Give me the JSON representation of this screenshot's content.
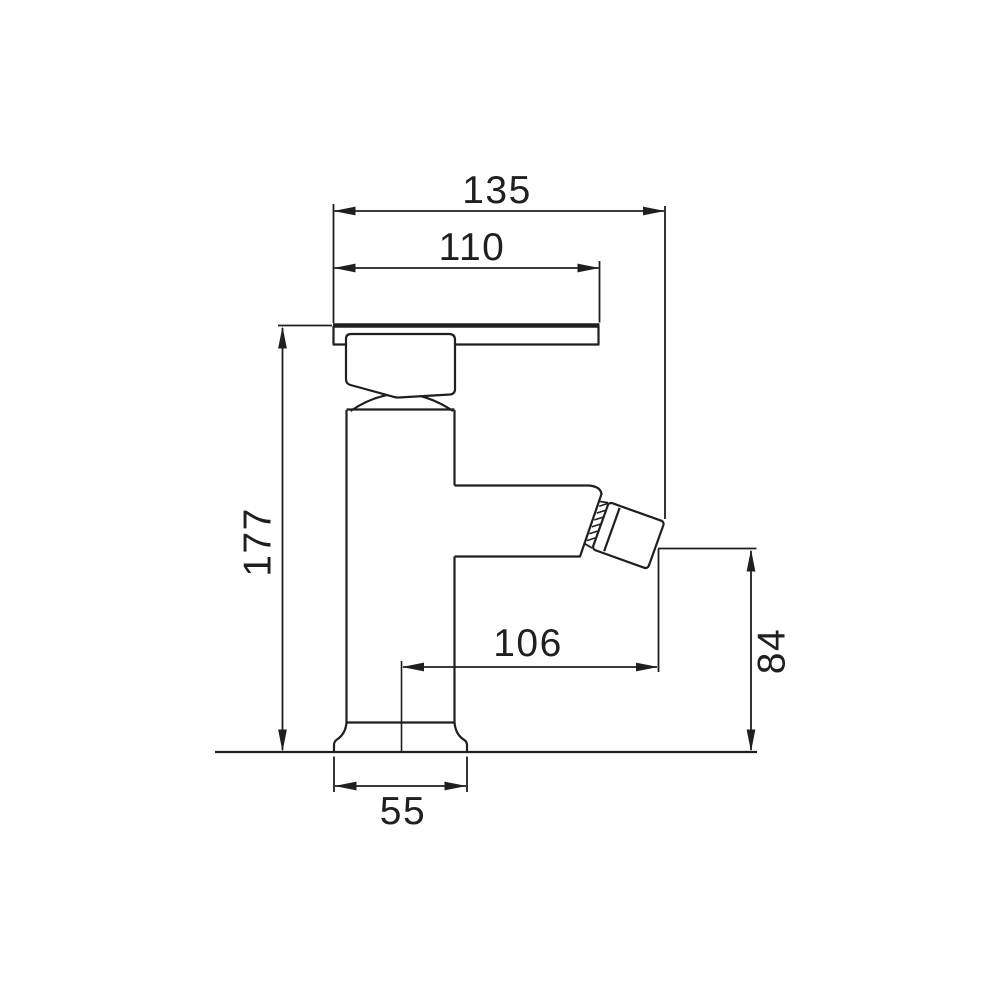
{
  "drawing": {
    "subject": "Bidet mixer tap - technical dimension drawing, side view",
    "background_color": "#ffffff",
    "line_color": "#1f1f1f",
    "labels": {
      "overall_width": "135",
      "plate_width": "110",
      "overall_height": "177",
      "spout_reach": "106",
      "outlet_height": "84",
      "base_width": "55"
    }
  }
}
